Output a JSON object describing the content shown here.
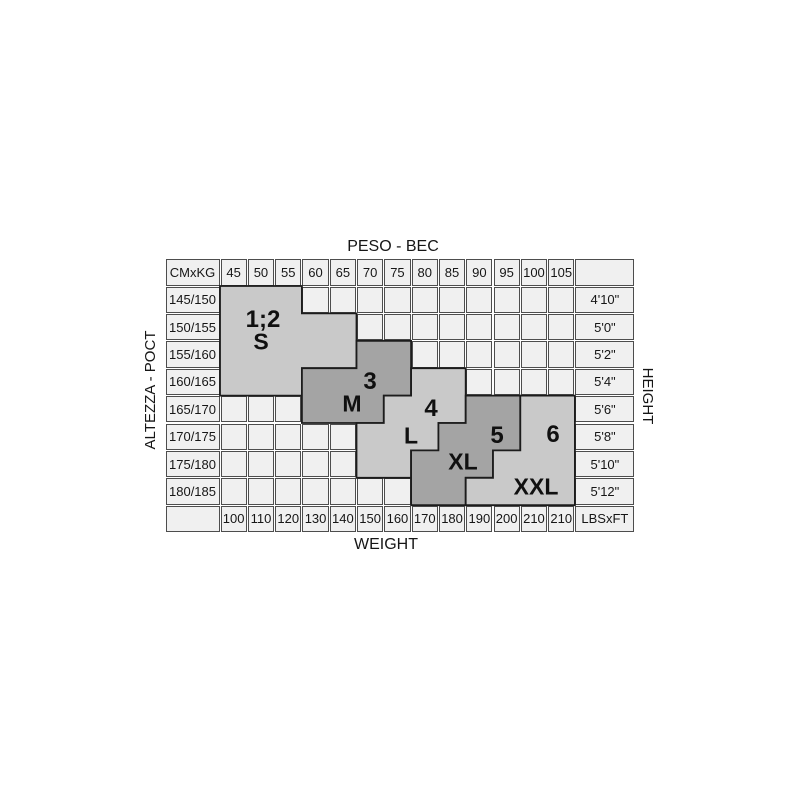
{
  "titles": {
    "top": "PESO - BEC",
    "bottom": "WEIGHT",
    "left": "ALTEZZA - POCT",
    "right": "HEIGHT"
  },
  "table": {
    "corner_top_left": "CMxKG",
    "corner_bottom_right": "LBSxFT",
    "kg_headers": [
      "45",
      "50",
      "55",
      "60",
      "65",
      "70",
      "75",
      "80",
      "85",
      "90",
      "95",
      "100",
      "105"
    ],
    "lbs_footers": [
      "100",
      "110",
      "120",
      "130",
      "140",
      "150",
      "160",
      "170",
      "180",
      "190",
      "200",
      "210",
      "210"
    ],
    "cm_rows": [
      "145/150",
      "150/155",
      "155/160",
      "160/165",
      "165/170",
      "170/175",
      "175/180",
      "180/185"
    ],
    "ft_rows": [
      "4'10\"",
      "5'0\"",
      "5'2\"",
      "5'4\"",
      "5'6\"",
      "5'8\"",
      "5'10\"",
      "5'12\""
    ]
  },
  "colors": {
    "cell_bg": "#f0f0f0",
    "cell_border": "#4d4d4d",
    "region_light": "#c9c9c9",
    "region_dark": "#a4a4a4",
    "region_outline": "#1c1c1c",
    "text": "#161616"
  },
  "regions": [
    {
      "number": "1;2",
      "letter": "S",
      "shade": "light",
      "spans": [
        [
          0,
          0,
          2
        ],
        [
          1,
          0,
          4
        ],
        [
          2,
          0,
          4
        ],
        [
          3,
          0,
          2
        ]
      ],
      "number_pos": [
        98,
        62
      ],
      "letter_pos": [
        96,
        84
      ]
    },
    {
      "number": "3",
      "letter": "M",
      "shade": "dark",
      "spans": [
        [
          2,
          5,
          6
        ],
        [
          3,
          3,
          6
        ],
        [
          4,
          3,
          5
        ]
      ],
      "number_pos": [
        205,
        124
      ],
      "letter_pos": [
        187,
        146
      ]
    },
    {
      "number": "4",
      "letter": "L",
      "shade": "light",
      "spans": [
        [
          3,
          7,
          8
        ],
        [
          4,
          6,
          8
        ],
        [
          5,
          5,
          7
        ],
        [
          6,
          5,
          6
        ]
      ],
      "number_pos": [
        266,
        151
      ],
      "letter_pos": [
        246,
        178
      ]
    },
    {
      "number": "5",
      "letter": "XL",
      "shade": "dark",
      "spans": [
        [
          4,
          9,
          10
        ],
        [
          5,
          8,
          10
        ],
        [
          6,
          7,
          9
        ],
        [
          7,
          7,
          8
        ]
      ],
      "number_pos": [
        332,
        178
      ],
      "letter_pos": [
        298,
        204
      ]
    },
    {
      "number": "6",
      "letter": "XXL",
      "shade": "light",
      "spans": [
        [
          4,
          11,
          12
        ],
        [
          5,
          11,
          12
        ],
        [
          6,
          10,
          12
        ],
        [
          7,
          9,
          12
        ]
      ],
      "number_pos": [
        388,
        177
      ],
      "letter_pos": [
        371,
        229
      ]
    }
  ],
  "chart_data": {
    "type": "table",
    "title": "PESO - BEC",
    "xlabel": "WEIGHT",
    "ylabel_left": "ALTEZZA - POCT",
    "ylabel_right": "HEIGHT",
    "weight_kg": [
      45,
      50,
      55,
      60,
      65,
      70,
      75,
      80,
      85,
      90,
      95,
      100,
      105
    ],
    "weight_lbs": [
      100,
      110,
      120,
      130,
      140,
      150,
      160,
      170,
      180,
      190,
      200,
      210,
      210
    ],
    "height_cm": [
      "145/150",
      "150/155",
      "155/160",
      "160/165",
      "165/170",
      "170/175",
      "175/180",
      "180/185"
    ],
    "height_ft": [
      "4'10\"",
      "5'0\"",
      "5'2\"",
      "5'4\"",
      "5'6\"",
      "5'8\"",
      "5'10\"",
      "5'12\""
    ],
    "units_corner_top": "CMxKG",
    "units_corner_bottom": "LBSxFT",
    "sizes": [
      {
        "size": "1;2 S",
        "shade": "light",
        "cells_kg_by_cm": {
          "145/150": [
            45,
            55
          ],
          "150/155": [
            45,
            65
          ],
          "155/160": [
            45,
            65
          ],
          "160/165": [
            45,
            55
          ]
        }
      },
      {
        "size": "3 M",
        "shade": "dark",
        "cells_kg_by_cm": {
          "155/160": [
            70,
            75
          ],
          "160/165": [
            60,
            75
          ],
          "165/170": [
            60,
            70
          ]
        }
      },
      {
        "size": "4 L",
        "shade": "light",
        "cells_kg_by_cm": {
          "160/165": [
            80,
            85
          ],
          "165/170": [
            75,
            85
          ],
          "170/175": [
            70,
            80
          ],
          "175/180": [
            70,
            75
          ]
        }
      },
      {
        "size": "5 XL",
        "shade": "dark",
        "cells_kg_by_cm": {
          "165/170": [
            90,
            95
          ],
          "170/175": [
            85,
            95
          ],
          "175/180": [
            80,
            90
          ],
          "180/185": [
            80,
            85
          ]
        }
      },
      {
        "size": "6 XXL",
        "shade": "light",
        "cells_kg_by_cm": {
          "165/170": [
            100,
            105
          ],
          "170/175": [
            100,
            105
          ],
          "175/180": [
            95,
            105
          ],
          "180/185": [
            90,
            105
          ]
        }
      }
    ]
  }
}
